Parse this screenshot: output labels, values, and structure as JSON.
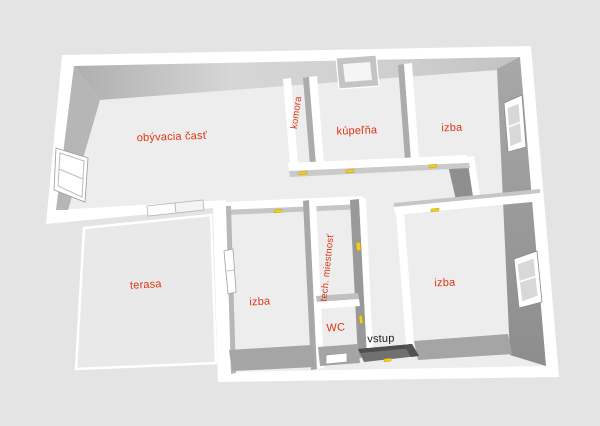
{
  "scene": {
    "background": "#e4e4e4",
    "wall_top_color": "#ffffff",
    "floor_color": "#ededed",
    "label_color": "#de3413",
    "entry_label_color": "#1c1c1c",
    "door_marker_color": "#f2ce1b"
  },
  "rooms": {
    "living": {
      "label": "obývacia časť"
    },
    "pantry": {
      "label": "komora"
    },
    "bathroom": {
      "label": "kúpeľňa"
    },
    "room_top_right": {
      "label": "izba"
    },
    "terrace": {
      "label": "terasa"
    },
    "room_bottom_middle": {
      "label": "izba"
    },
    "utility": {
      "label": "tech. miestnosť"
    },
    "wc": {
      "label": "WC"
    },
    "entry": {
      "label": "vstup"
    },
    "room_bottom_right": {
      "label": "izba"
    }
  }
}
